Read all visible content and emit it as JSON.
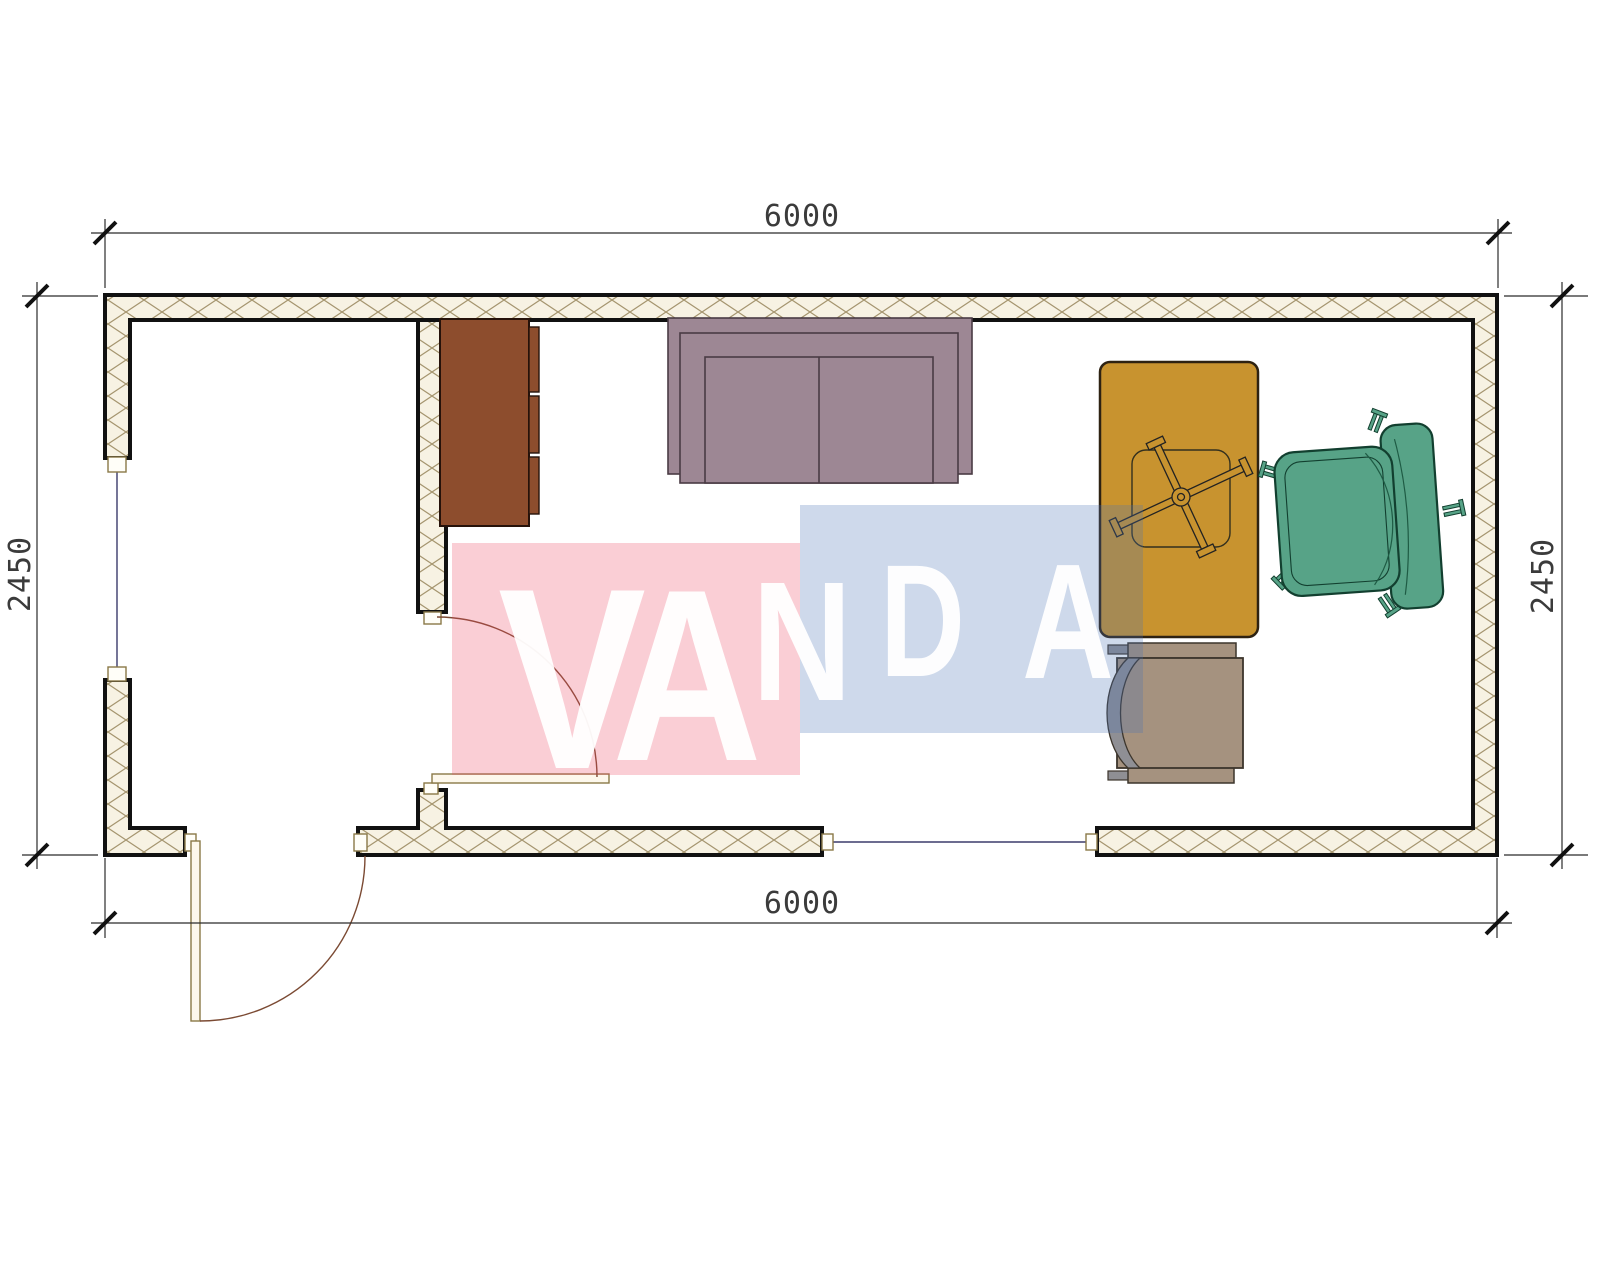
{
  "drawing": {
    "kind": "floor-plan",
    "room": {
      "width_mm": "6000",
      "depth_mm": "2450"
    }
  },
  "dimensions": {
    "top_label": "6000",
    "bottom_label": "6000",
    "left_label": "2450",
    "right_label": "2450"
  },
  "watermark": {
    "text": "VANDA",
    "pink_color": "#ee4b64",
    "blue_color": "#4a74b4",
    "letter_color": "#ffffff"
  },
  "palette": {
    "wall_fill": "#f7f2e3",
    "wall_hatch": "#a5956f",
    "wall_edge": "#111111",
    "window_glazing": "#3b3b6b",
    "door_frame": "#8a7948",
    "door_arc": "#7b4a33"
  },
  "furniture": {
    "cabinet": {
      "name": "cabinet",
      "color": "#8d4d2d"
    },
    "sofa": {
      "name": "sofa",
      "color": "#9d8794"
    },
    "desk": {
      "name": "desk",
      "color": "#c8932f"
    },
    "armchair": {
      "name": "armchair",
      "color": "#57a387"
    },
    "chair": {
      "name": "desk-chair",
      "color": "#a5927f"
    },
    "chair_back_color": "#8f8f94"
  }
}
